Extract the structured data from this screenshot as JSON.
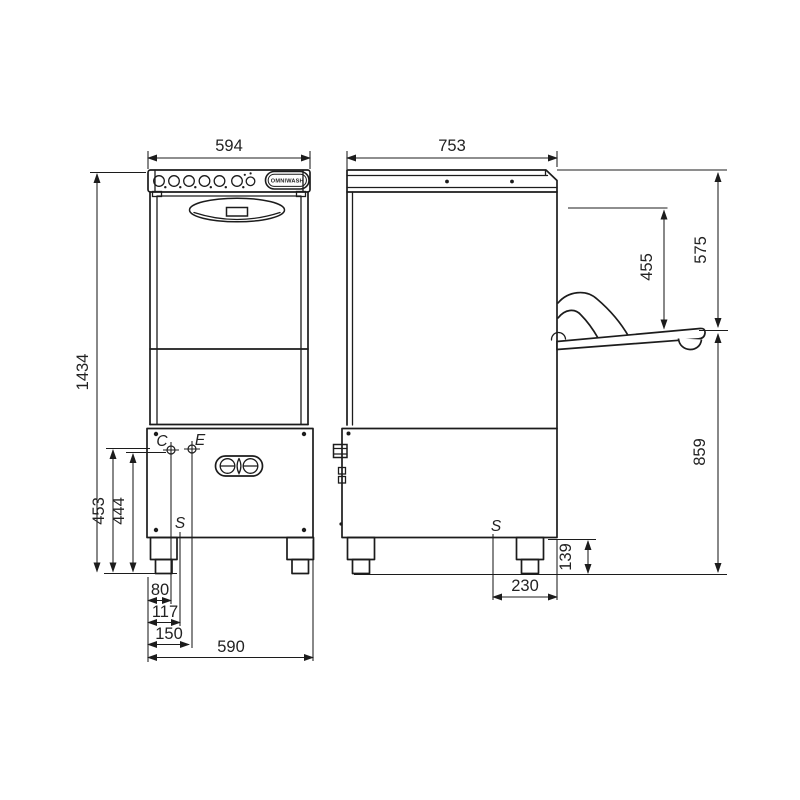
{
  "colors": {
    "line": "#1c1c1c",
    "background": "#ffffff"
  },
  "brand": {
    "logo_text": "OMNIWASH"
  },
  "front_view": {
    "dim_width_top": "594",
    "dim_height_total": "1434",
    "dim_height_453": "453",
    "dim_height_444": "444",
    "point_c": "C",
    "point_e": "E",
    "point_s": "S",
    "dim_80": "80",
    "dim_117": "117",
    "dim_150": "150",
    "dim_base_width": "590"
  },
  "side_view": {
    "dim_depth_top": "753",
    "dim_455": "455",
    "dim_575": "575",
    "dim_859": "859",
    "point_s": "S",
    "dim_230": "230",
    "dim_139": "139"
  }
}
